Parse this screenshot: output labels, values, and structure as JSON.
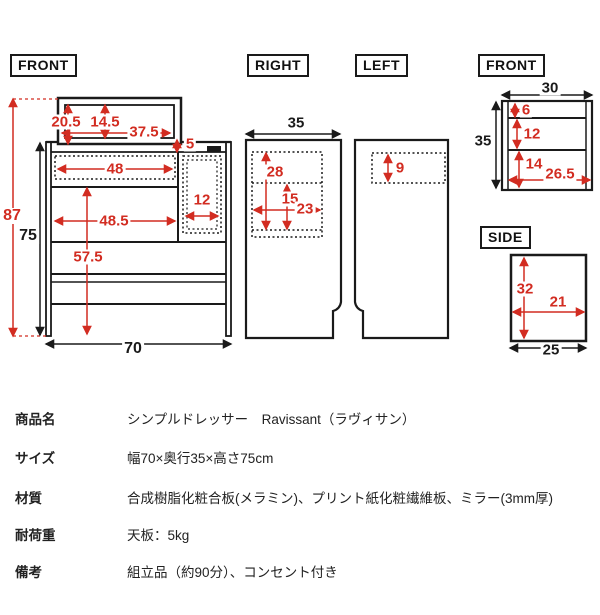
{
  "colors": {
    "dimension_red": "#d22c21",
    "line_black": "#1a1a1a"
  },
  "views": {
    "front_main": {
      "label": "FRONT",
      "dims": {
        "total_height": "87",
        "body_height": "75",
        "bottom_width": "70",
        "mirror_height": "20.5",
        "mirror_inner_height": "14.5",
        "mirror_width": "37.5",
        "top_thickness": "5",
        "top_shelf_width": "48",
        "door_width": "12",
        "open_width": "48.5",
        "open_height": "57.5"
      }
    },
    "right": {
      "label": "RIGHT",
      "dims": {
        "depth": "35",
        "mirror_zone_height": "28",
        "inner_height": "15",
        "inner_width": "23"
      }
    },
    "left": {
      "label": "LEFT",
      "dims": {
        "shelf_zone_height": "9"
      }
    },
    "front_small": {
      "label": "FRONT",
      "dims": {
        "width": "30",
        "height": "35",
        "row1_height": "6",
        "row2_height": "12",
        "row3_height": "14",
        "inner_width": "26.5"
      }
    },
    "side": {
      "label": "SIDE",
      "dims": {
        "height": "32",
        "inner_width": "21",
        "width": "25"
      }
    }
  },
  "spec_table": {
    "rows": [
      {
        "label": "商品名",
        "value": "シンプルドレッサー　Ravissant（ラヴィサン）"
      },
      {
        "label": "サイズ",
        "value": "幅70×奥行35×高さ75cm"
      },
      {
        "label": "材質",
        "value": "合成樹脂化粧合板(メラミン)、プリント紙化粧繊維板、ミラー(3mm厚)"
      },
      {
        "label": "耐荷重",
        "value": "天板：5kg"
      },
      {
        "label": "備考",
        "value": "組立品（約90分）、コンセント付き"
      }
    ]
  }
}
